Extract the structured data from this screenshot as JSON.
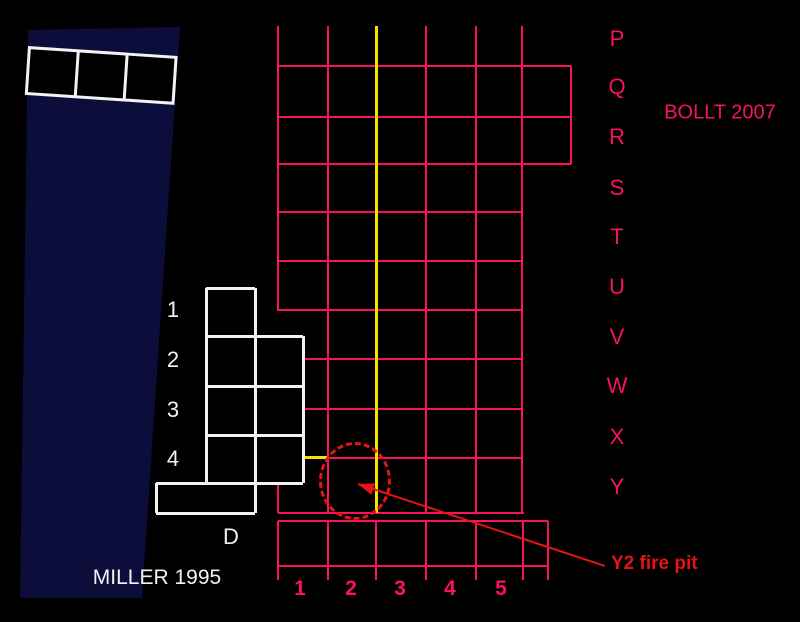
{
  "colors": {
    "background": "#000000",
    "grid_pink": "#f8125f",
    "section_yellow": "#f5e300",
    "annotation_red": "#e81313",
    "trench_white": "#f2f2f2",
    "strip_navy": "#0d0d3c"
  },
  "labels": {
    "bollt": "BOLLT 2007",
    "miller": "MILLER 1995",
    "fire_pit": "Y2 fire pit",
    "trench_d": "D"
  },
  "grid": {
    "row_labels": [
      "P",
      "Q",
      "R",
      "S",
      "T",
      "U",
      "V",
      "W",
      "X",
      "Y"
    ],
    "column_labels": [
      "1",
      "2",
      "3",
      "4",
      "5"
    ]
  },
  "trench": {
    "row_labels": [
      "1",
      "2",
      "3",
      "4"
    ]
  },
  "diagram": {
    "canvas": {
      "w": 800,
      "h": 622
    },
    "navy_strip_points": "28px 30px, 180px 27px, 142px 598px, 20px 598px",
    "tilted_squares": {
      "x": 28,
      "y": 46,
      "w": 150,
      "h": 49,
      "angle": 3.8,
      "cells": 3,
      "line": 3
    },
    "grid_v": [
      [
        278,
        26,
        311
      ],
      [
        278,
        458,
        513
      ],
      [
        328,
        26,
        513
      ],
      [
        377,
        26,
        513
      ],
      [
        426,
        26,
        513
      ],
      [
        476,
        26,
        513
      ],
      [
        522,
        26,
        513
      ],
      [
        571,
        66,
        164
      ],
      [
        278,
        521,
        580
      ],
      [
        328,
        521,
        580
      ],
      [
        376,
        521,
        580
      ],
      [
        426,
        521,
        580
      ],
      [
        476,
        521,
        580
      ],
      [
        523,
        521,
        580
      ],
      [
        548,
        521,
        580
      ]
    ],
    "grid_h": [
      [
        66,
        278,
        571
      ],
      [
        117,
        278,
        571
      ],
      [
        164,
        278,
        571
      ],
      [
        212,
        278,
        522
      ],
      [
        261,
        278,
        522
      ],
      [
        310,
        278,
        522
      ],
      [
        359,
        278,
        522
      ],
      [
        409,
        278,
        522
      ],
      [
        458,
        278,
        522
      ],
      [
        513,
        278,
        524
      ],
      [
        521,
        278,
        548
      ],
      [
        566,
        278,
        548
      ]
    ],
    "yellow_v": [
      [
        376,
        26,
        513
      ]
    ],
    "yellow_h": [
      [
        457,
        291,
        327
      ]
    ],
    "trench_fills": [
      [
        206,
        288,
        49,
        48
      ],
      [
        206,
        336,
        97,
        147
      ],
      [
        156,
        483,
        99,
        30
      ]
    ],
    "trench_v": [
      [
        206,
        288,
        483
      ],
      [
        255,
        288,
        513
      ],
      [
        303,
        336,
        483
      ],
      [
        156,
        483,
        513
      ]
    ],
    "trench_h": [
      [
        288,
        206,
        255
      ],
      [
        336,
        206,
        303
      ],
      [
        386,
        206,
        303
      ],
      [
        435,
        206,
        303
      ],
      [
        483,
        156,
        303
      ],
      [
        513,
        156,
        255
      ]
    ],
    "fire_pit_ellipse": {
      "cx": 355,
      "cy": 481,
      "rx": 36,
      "ry": 39
    },
    "arrow": {
      "x1": 605,
      "y1": 566,
      "x2": 358,
      "y2": 484
    },
    "label_positions": {
      "bollt": {
        "x": 720,
        "y": 113,
        "size": 20,
        "weight": 400,
        "color": "grid_pink"
      },
      "miller": {
        "x": 157,
        "y": 578,
        "size": 21,
        "weight": 400,
        "color": "trench_white"
      },
      "fire_pit": {
        "x": 611,
        "y": 564,
        "size": 19,
        "weight": 700,
        "color": "annotation_red",
        "anchor": "left"
      },
      "trench_d": {
        "x": 231,
        "y": 537,
        "size": 22,
        "weight": 400,
        "color": "trench_white"
      },
      "grid_rows": {
        "x": 617,
        "ys": [
          39,
          87,
          137,
          188,
          237,
          287,
          337,
          386,
          437,
          487
        ],
        "size": 22,
        "weight": 400
      },
      "grid_cols": {
        "y": 589,
        "xs": [
          300,
          351,
          400,
          450,
          501
        ],
        "size": 21,
        "weight": 700
      },
      "trench_rows": {
        "x": 173,
        "ys": [
          310,
          360,
          410,
          459
        ],
        "size": 22,
        "weight": 400
      }
    }
  }
}
